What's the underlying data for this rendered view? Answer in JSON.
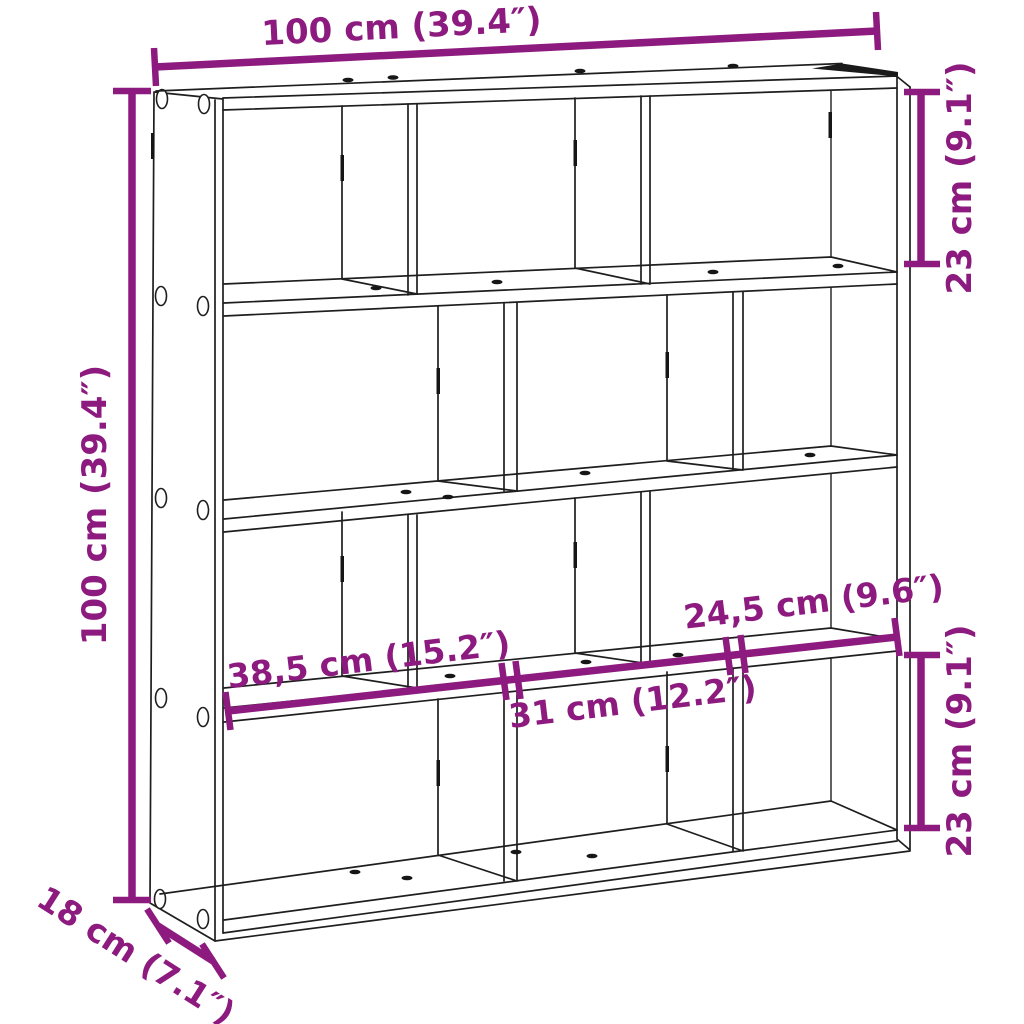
{
  "diagram": {
    "product": "wall-cube-shelf",
    "structure": {
      "rows": 4,
      "columns": 3,
      "compartments": 12
    },
    "dimensions": {
      "width": "100 cm (39.4″)",
      "height": "100 cm (39.4″)",
      "depth": "18 cm (7.1″)",
      "compartment_height_top": "23 cm (9.1″)",
      "compartment_height_bottom": "23 cm (9.1″)",
      "compartment_widths": [
        "38,5 cm (15.2″)",
        "31 cm (12.2″)",
        "24,5 cm (9.6″)"
      ]
    },
    "colors": {
      "dimension_accent": "#8D1A7E",
      "line": "#1E1E1E",
      "background": "#FFFFFF"
    }
  }
}
